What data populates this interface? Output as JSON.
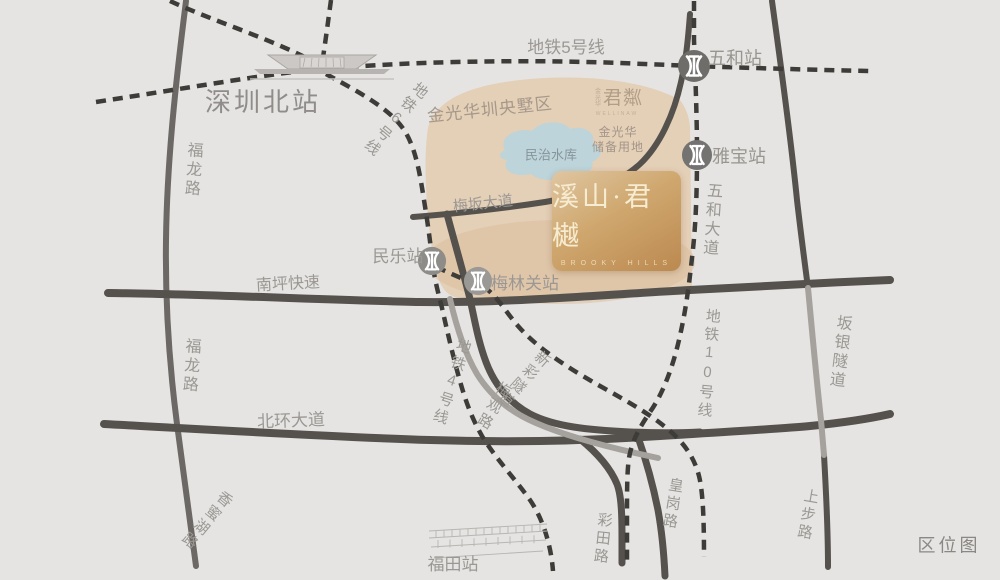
{
  "title_corner": "区位图",
  "stations": {
    "shenzhen_north": "深圳北站",
    "wuhe": "五和站",
    "yabao": "雅宝站",
    "minle": "民乐站",
    "meilinguan": "梅林关站",
    "futian": "福田站"
  },
  "metro_lines": {
    "line4": "地铁4号线",
    "line5": "地铁5号线",
    "line6": "地铁6号线",
    "line10": "地铁10号线"
  },
  "roads": {
    "fulong_upper": "福龙路",
    "fulong_lower": "福龙路",
    "nanping_expressway": "南坪快速",
    "meiban_avenue": "梅坂大道",
    "wuhe_avenue": "五和大道",
    "beihuan_avenue": "北环大道",
    "meiguan_road": "梅观路",
    "xincai_tunnel": "新彩隧道",
    "banyin_tunnel": "坂银隧道",
    "xiangmihu_road": "香蜜湖路",
    "caitian_road": "彩田路",
    "huanggang_road": "皇岗路",
    "shangbu_road": "上步路"
  },
  "areas": {
    "estate_zone": "金光华圳央墅区",
    "reserved_land_line1": "金光华",
    "reserved_land_line2": "储备用地",
    "reservoir": "民治水库"
  },
  "project_card": {
    "name": "溪山·君樾",
    "subtitle_en": "BROOKY HILLS"
  },
  "junlin_logo": {
    "prefix": "金光华",
    "name": "君粼",
    "subtitle_en": "WELLINAW"
  },
  "colors": {
    "background": "#e5e4e2",
    "road_dark": "#55524e",
    "road_light": "#a5a19d",
    "metro_dash": "#3e3c39",
    "label_gray": "#9b9894",
    "beige_area": "#e4cfb7",
    "water": "#bcd4da",
    "card_gold": "#c9a369"
  }
}
